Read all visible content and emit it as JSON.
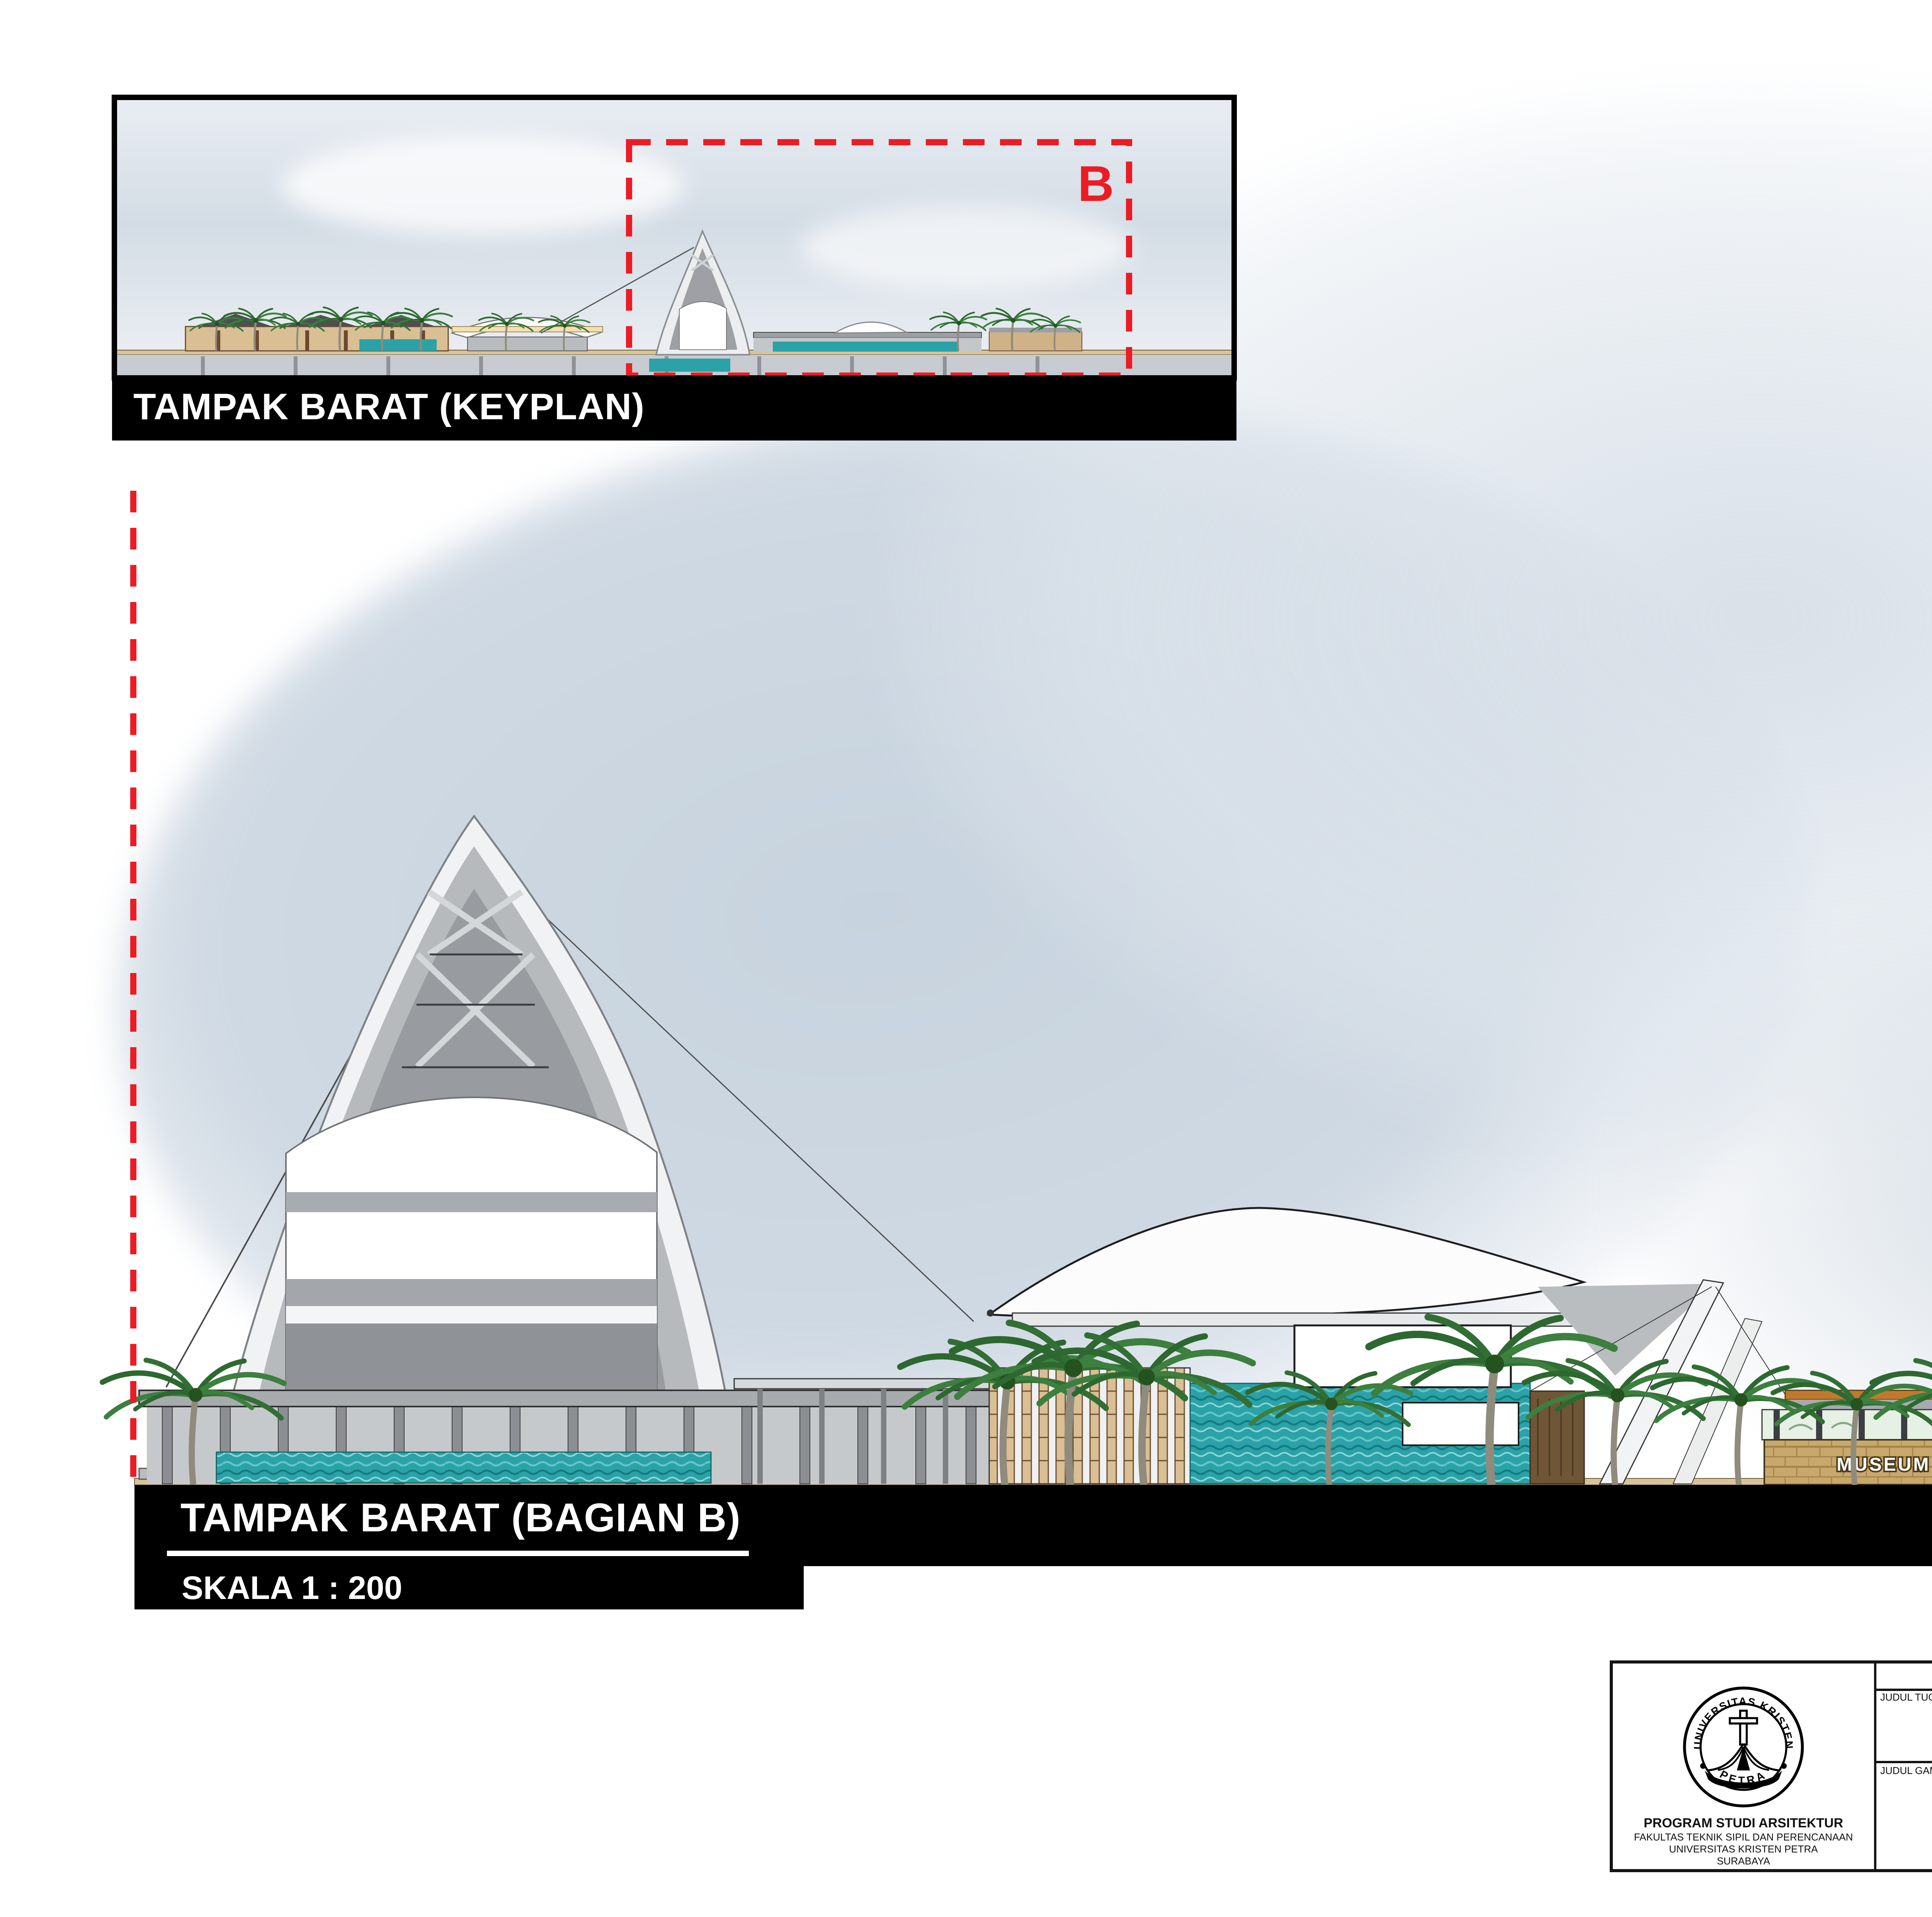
{
  "keyplan": {
    "title": "TAMPAK BARAT (KEYPLAN)",
    "section_marker": "B"
  },
  "main": {
    "title": "TAMPAK BARAT (BAGIAN B)",
    "scale": "SKALA 1 : 200",
    "museum_sign": "MUSEUM NELAYAN"
  },
  "tb": {
    "header": "TUGAS AKHIR - SEMESTER GENAP 2016/2017",
    "judul_tugas_label": "JUDUL TUGAS",
    "judul_tugas_1": "FASILITAS EDUWISATA NELAYAN",
    "judul_tugas_2": "DI KENJERAN, SURABAYA",
    "judul_gambar_label": "JUDUL GAMBAR",
    "judul_gambar": "TAMPAK BARAT (BAGIAN B)",
    "skala_label": "SKALA",
    "skala": "1 : 200",
    "nama_label": "NAMA",
    "nama": "RICHARD BORTON",
    "nrp_label": "NRP",
    "nrp": "22413019",
    "kelompok_label": "KELOMPOK",
    "kelompok": "5",
    "mentor_utama_label": "MENTOR UTAMA",
    "mentor_utama": "Ir. DANNY S MINTOROGO, M.Arch, PH.D.",
    "mentor_pendamping_label": "MENTOR PENDAMPING",
    "mentor_pendamping": [
      "Prof. Ir. LILIANNY SIGIT, M.Sc, Ph.D",
      "Ir. BISATYA W MAER, M.T",
      "ANIK JUNIWATI, S.T, M.T"
    ],
    "lembar_label": "LEMBAR",
    "jumlah_label": "JUMLAH",
    "dept": {
      "line1": "PROGRAM STUDI ARSITEKTUR",
      "line2": "FAKULTAS TEKNIK SIPIL DAN PERENCANAAN",
      "line3": "UNIVERSITAS KRISTEN PETRA",
      "line4": "SURABAYA"
    },
    "logo": {
      "top_arc": "UNIVERSITAS KRISTEN",
      "bottom_arc": "PETRA"
    }
  },
  "colors": {
    "marker_red": "#ec1c24",
    "water_teal": "#2ba2a7",
    "wood_tan": "#d9bf93",
    "brick_tan": "#c9a96b",
    "bar_black": "#000000",
    "sky_gray_blue": "#cfd9e2"
  }
}
